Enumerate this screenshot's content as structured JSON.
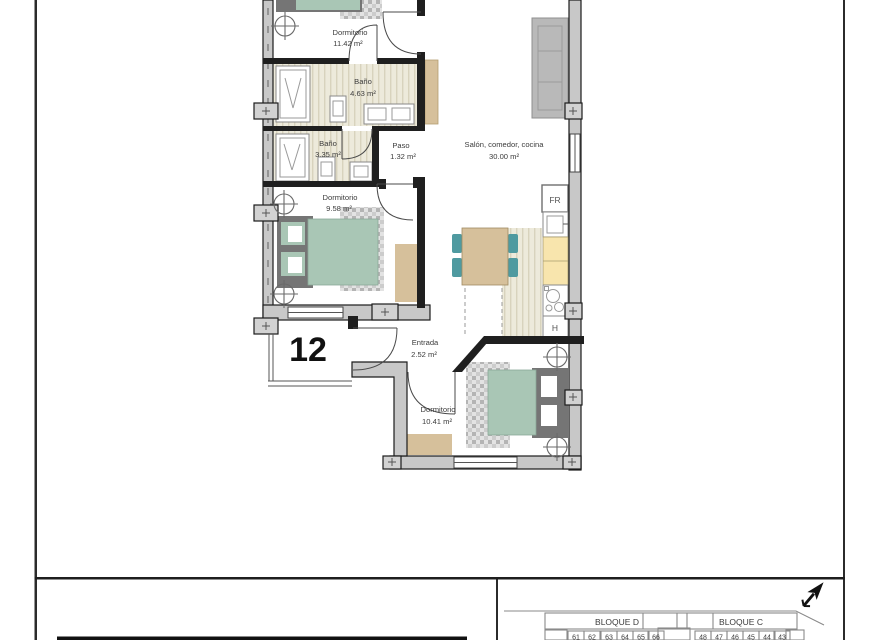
{
  "unit_number": "12",
  "rooms": {
    "dormitorio1": {
      "name": "Dormitorio",
      "area": "11.42 m²"
    },
    "bano1": {
      "name": "Baño",
      "area": "4.63 m²"
    },
    "bano2": {
      "name": "Baño",
      "area": "3.35 m²"
    },
    "paso": {
      "name": "Paso",
      "area": "1.32 m²"
    },
    "salon": {
      "name": "Salón, comedor, cocina",
      "area": "30.00 m²"
    },
    "dormitorio2": {
      "name": "Dormitorio",
      "area": "9.58 m²"
    },
    "entrada": {
      "name": "Entrada",
      "area": "2.52 m²"
    },
    "dormitorio3": {
      "name": "Dormitorio",
      "area": "10.41 m²"
    }
  },
  "kitchen": {
    "fridge_label": "FR",
    "oven_label": "H"
  },
  "title_block": {
    "bloque_d": "BLOQUE D",
    "bloque_c": "BLOQUE C",
    "units_left": [
      "61",
      "62",
      "63",
      "64",
      "65",
      "66"
    ],
    "units_right": [
      "48",
      "47",
      "46",
      "45",
      "44",
      "43"
    ]
  },
  "colors": {
    "bed_teal": "#a9c6b5",
    "headboard_gray": "#757575",
    "furniture_tan": "#d6c09b",
    "counter_yellow": "#f8e5ad",
    "chair_teal": "#4f9aa0",
    "sofa_gray": "#b9b9b9",
    "wall_gray": "#c8c8c8"
  }
}
